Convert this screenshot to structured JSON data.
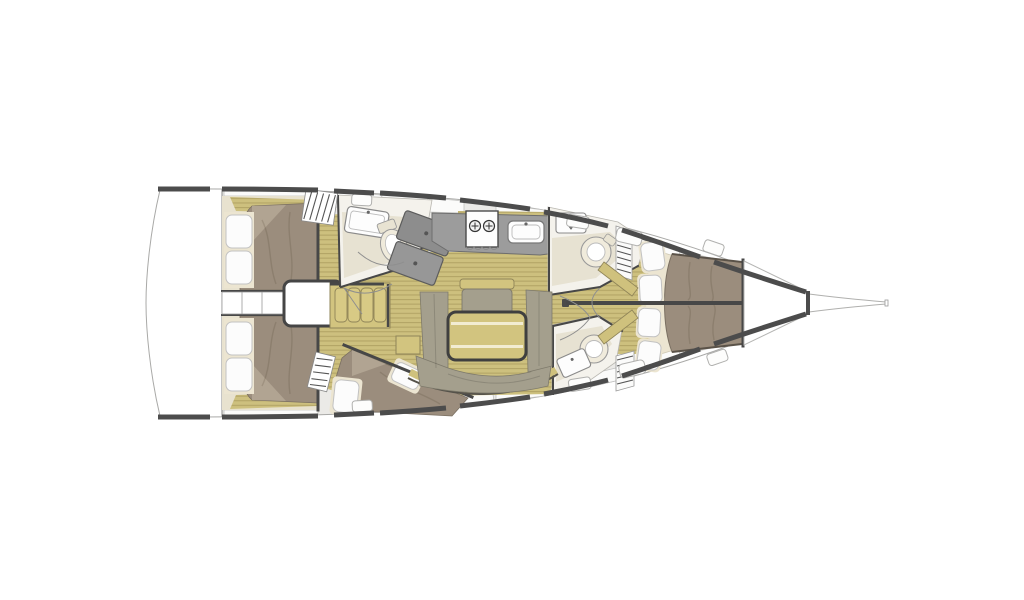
{
  "meta": {
    "title": "Sailing yacht interior deck plan",
    "type": "boat-floor-plan",
    "orientation": "bow-right, stern-left, top-down view",
    "text_on_screen": "none"
  },
  "colors": {
    "background": "#ffffff",
    "deck": "#ebeae7",
    "transom": "#ffffff",
    "panel_white": "#fbfbfa",
    "hull_rail": "#4c4c4c",
    "wall": "#474747",
    "outline_thin": "#a9a9a7",
    "floor": "#cdc07e",
    "floor_stripe": "#b3a566",
    "furniture_tan": "#d2c47f",
    "furniture_tan_edge": "#8f8458",
    "table_stripe": "#f2ecd2",
    "mattress": "#9b8d7d",
    "mattress_fold": "#b1a492",
    "mattress_edge": "#7a6f61",
    "headboard": "#ece5d1",
    "pillow": "#fcfcfc",
    "pillow_edge": "#c2c2c2",
    "cushion": "#a49f8d",
    "cushion_edge": "#7e7a6b",
    "counter": "#9c9c9c",
    "counter_edge": "#6e6e6e",
    "shower_dark": "#8d8d8d",
    "shower_light": "#979797",
    "shower_edge": "#5c5c5c",
    "head_wall": "#f4f2ec",
    "head_floor": "#e7e2d2",
    "fixture": "#fdfdfd",
    "fixture_edge": "#8a8a8a",
    "toilet": "#f0ebdc"
  },
  "regions": {
    "transom": "open transom / swim platform",
    "aft_cabin_port": "aft double cabin, port side",
    "aft_cabin_starboard": "aft double cabin, starboard side",
    "companionway": "companionway steps and engine box",
    "port_settee": "port side sofa with four cushions",
    "port_head": "port head with sink and toilet",
    "port_shower": "separate shower stall",
    "galley": "galley with two-burner stove and sink",
    "forward_head": "forward starboard head",
    "aft_starboard_head": "aft starboard head",
    "guest_cabin": "mid-starboard guest cabin with diagonal berth",
    "salon": "salon with U-settee, folding table and bench",
    "forward_cabin": "forward owner cabin with island berth",
    "bow_locker": "bow / anchor locker",
    "bowsprit": "bowsprit"
  },
  "icons": {
    "stove_burner": "circle with cross",
    "sink": "rounded rectangle with faucet dot",
    "toilet": "circle / ellipse with seat ring",
    "steps": "hatched rectangle",
    "door_swing": "thin arc line"
  }
}
